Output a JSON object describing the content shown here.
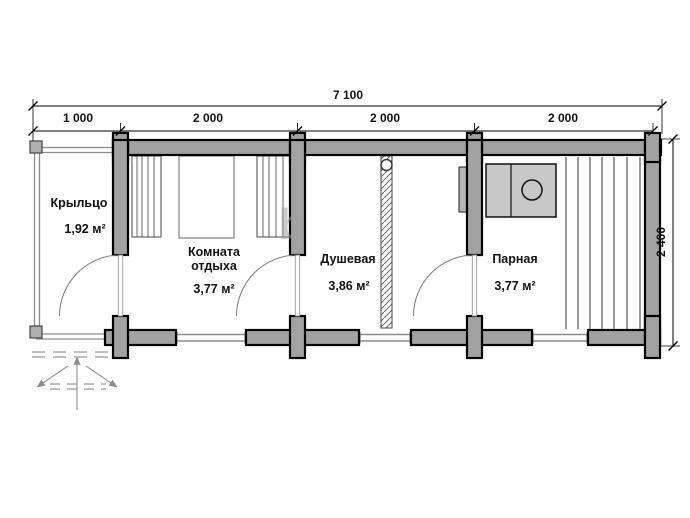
{
  "plan": {
    "dimensions": {
      "total": "7 100",
      "segments": [
        "1 000",
        "2 000",
        "2 000",
        "2 000"
      ],
      "depth": "2 400"
    },
    "rooms": [
      {
        "name": "Крыльцо",
        "area": "1,92 м²"
      },
      {
        "name": "Комната отдыха",
        "area": "3,77 м²"
      },
      {
        "name": "Душевая",
        "area": "3,86 м²"
      },
      {
        "name": "Парная",
        "area": "3,77 м²"
      }
    ],
    "watermark": "b",
    "colors": {
      "wall_fill": "#a2a2a2",
      "wall_outline": "#000000",
      "thin_line": "#8c8c8c",
      "furniture_fill": "#c8c8c8",
      "text": "#111111"
    }
  }
}
